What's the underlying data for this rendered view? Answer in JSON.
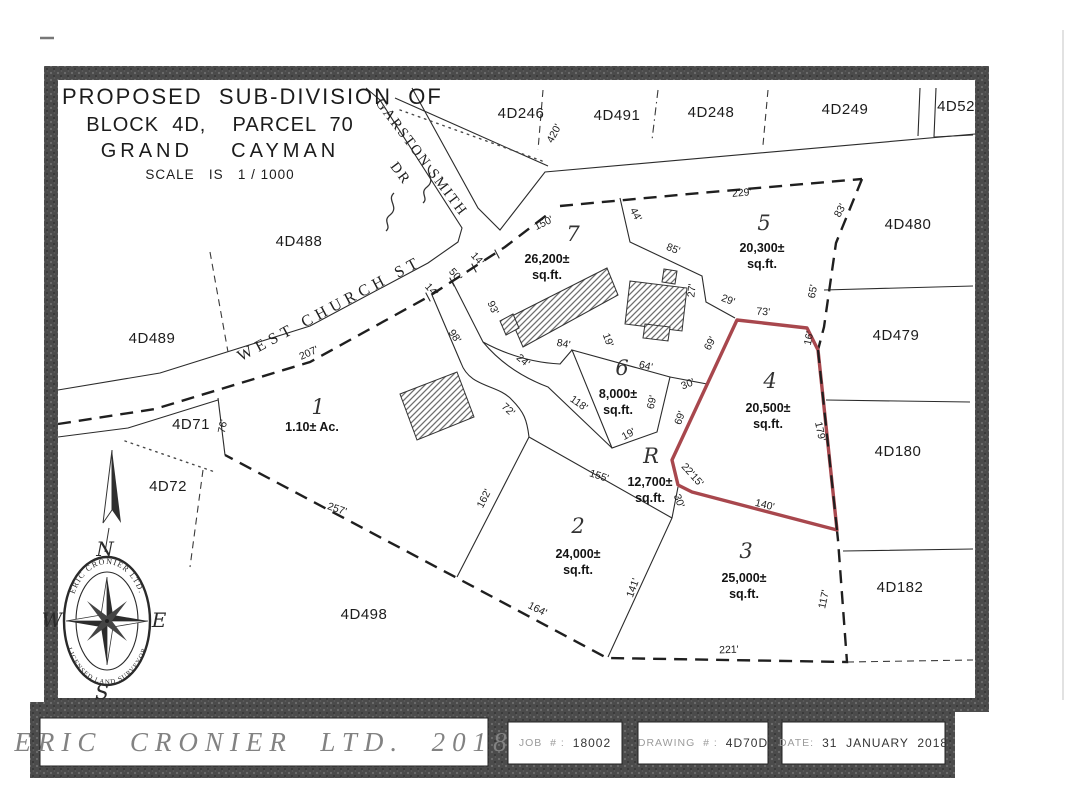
{
  "title_block": {
    "line1": "PROPOSED  SUB-DIVISION  OF",
    "line2": "BLOCK  4D,    PARCEL  70",
    "line3": "GRAND    CAYMAN",
    "line4": "SCALE   IS   1 / 1000"
  },
  "streets": [
    {
      "t": "WEST  CHURCH  ST",
      "x": 332,
      "y": 313,
      "r": -28,
      "c": "street"
    },
    {
      "t": "GARSTON  SMITH",
      "x": 418,
      "y": 160,
      "r": 53,
      "c": "street garston"
    },
    {
      "t": "DR",
      "x": 397,
      "y": 176,
      "r": 53,
      "c": "street garston"
    }
  ],
  "adjacent_parcels": [
    {
      "id": "4D246",
      "x": 521,
      "y": 118
    },
    {
      "id": "4D491",
      "x": 617,
      "y": 120
    },
    {
      "id": "4D248",
      "x": 711,
      "y": 117
    },
    {
      "id": "4D249",
      "x": 845,
      "y": 114
    },
    {
      "id": "4D52",
      "x": 956,
      "y": 111
    },
    {
      "id": "4D488",
      "x": 299,
      "y": 246
    },
    {
      "id": "4D480",
      "x": 908,
      "y": 229
    },
    {
      "id": "4D489",
      "x": 152,
      "y": 343
    },
    {
      "id": "4D479",
      "x": 896,
      "y": 340
    },
    {
      "id": "4D71",
      "x": 191,
      "y": 429
    },
    {
      "id": "4D180",
      "x": 898,
      "y": 456
    },
    {
      "id": "4D72",
      "x": 168,
      "y": 491
    },
    {
      "id": "4D182",
      "x": 900,
      "y": 592
    },
    {
      "id": "4D498",
      "x": 364,
      "y": 619
    }
  ],
  "lots": [
    {
      "n": "1",
      "x": 318,
      "y": 414,
      "a1": "1.10±  Ac.",
      "ax": 312,
      "ay": 431
    },
    {
      "n": "2",
      "x": 578,
      "y": 533,
      "a1": "24,000±",
      "a2": "sq.ft.",
      "ax": 578,
      "ay": 558
    },
    {
      "n": "3",
      "x": 746,
      "y": 558,
      "a1": "25,000±",
      "a2": "sq.ft.",
      "ax": 744,
      "ay": 582
    },
    {
      "n": "4",
      "x": 770,
      "y": 388,
      "a1": "20,500±",
      "a2": "sq.ft.",
      "ax": 768,
      "ay": 412
    },
    {
      "n": "5",
      "x": 764,
      "y": 230,
      "a1": "20,300±",
      "a2": "sq.ft.",
      "ax": 762,
      "ay": 252
    },
    {
      "n": "6",
      "x": 622,
      "y": 375,
      "a1": "8,000±",
      "a2": "sq.ft.",
      "ax": 618,
      "ay": 398
    },
    {
      "n": "7",
      "x": 573,
      "y": 241,
      "a1": "26,200±",
      "a2": "sq.ft.",
      "ax": 547,
      "ay": 263
    },
    {
      "n": "R",
      "x": 651,
      "y": 463,
      "a1": "12,700±",
      "a2": "sq.ft.",
      "ax": 650,
      "ay": 486
    }
  ],
  "dimensions": [
    {
      "t": "420'",
      "x": 557,
      "y": 135,
      "r": -62
    },
    {
      "t": "229'",
      "x": 742,
      "y": 196,
      "r": -5
    },
    {
      "t": "150'",
      "x": 545,
      "y": 226,
      "r": -26
    },
    {
      "t": "44'",
      "x": 633,
      "y": 216,
      "r": 62
    },
    {
      "t": "85'",
      "x": 672,
      "y": 252,
      "r": 22
    },
    {
      "t": "83'",
      "x": 843,
      "y": 212,
      "r": -62
    },
    {
      "t": "65'",
      "x": 816,
      "y": 292,
      "r": -80
    },
    {
      "t": "27'",
      "x": 695,
      "y": 291,
      "r": -84
    },
    {
      "t": "29'",
      "x": 727,
      "y": 303,
      "r": 20
    },
    {
      "t": "73'",
      "x": 763,
      "y": 315,
      "r": 4
    },
    {
      "t": "16'",
      "x": 812,
      "y": 339,
      "r": -78
    },
    {
      "t": "14'",
      "x": 475,
      "y": 261,
      "r": 48
    },
    {
      "t": "50'",
      "x": 453,
      "y": 277,
      "r": 48
    },
    {
      "t": "14'",
      "x": 429,
      "y": 292,
      "r": 48
    },
    {
      "t": "93'",
      "x": 490,
      "y": 309,
      "r": 66
    },
    {
      "t": "98'",
      "x": 452,
      "y": 338,
      "r": 56
    },
    {
      "t": "207'",
      "x": 310,
      "y": 356,
      "r": -24
    },
    {
      "t": "24'",
      "x": 521,
      "y": 363,
      "r": 40
    },
    {
      "t": "84'",
      "x": 563,
      "y": 347,
      "r": 10
    },
    {
      "t": "19'",
      "x": 605,
      "y": 341,
      "r": 70
    },
    {
      "t": "64'",
      "x": 645,
      "y": 369,
      "r": 14
    },
    {
      "t": "69'",
      "x": 655,
      "y": 403,
      "r": -77
    },
    {
      "t": "30'",
      "x": 689,
      "y": 387,
      "r": -22
    },
    {
      "t": "69'",
      "x": 713,
      "y": 345,
      "r": -62
    },
    {
      "t": "69'",
      "x": 683,
      "y": 419,
      "r": -70
    },
    {
      "t": "118'",
      "x": 577,
      "y": 406,
      "r": 35
    },
    {
      "t": "19'",
      "x": 630,
      "y": 437,
      "r": -28
    },
    {
      "t": "179'",
      "x": 817,
      "y": 432,
      "r": 78
    },
    {
      "t": "22'15'",
      "x": 690,
      "y": 477,
      "r": 48
    },
    {
      "t": "30'",
      "x": 676,
      "y": 502,
      "r": 70
    },
    {
      "t": "140'",
      "x": 764,
      "y": 508,
      "r": 14
    },
    {
      "t": "155'",
      "x": 598,
      "y": 479,
      "r": 18
    },
    {
      "t": "162'",
      "x": 487,
      "y": 500,
      "r": -63
    },
    {
      "t": "72'",
      "x": 506,
      "y": 412,
      "r": 42
    },
    {
      "t": "257'",
      "x": 336,
      "y": 512,
      "r": 19
    },
    {
      "t": "76'",
      "x": 226,
      "y": 427,
      "r": -78
    },
    {
      "t": "164'",
      "x": 536,
      "y": 612,
      "r": 27
    },
    {
      "t": "141'",
      "x": 636,
      "y": 589,
      "r": -70
    },
    {
      "t": "221'",
      "x": 729,
      "y": 653,
      "r": -2
    },
    {
      "t": "117'",
      "x": 827,
      "y": 600,
      "r": -78
    }
  ],
  "compass": {
    "n": "N",
    "s": "S",
    "e": "E",
    "w": "W",
    "ring_top": "ERIC CRONIER LTD.",
    "ring_bottom": "LICENSED  LAND  SURVEYOR"
  },
  "footer": {
    "company": "ERIC  CRONIER  LTD.  2018",
    "job_label": "JOB  # :",
    "job_value": "18002",
    "drawing_label": "DRAWING  # :",
    "drawing_value": "4D70D",
    "date_label": "DATE:",
    "date_value": "31  JANUARY  2018"
  },
  "colors": {
    "highlight_red": "#a8474d",
    "frame_gray": "#4b4b4b",
    "line": "#232323"
  }
}
